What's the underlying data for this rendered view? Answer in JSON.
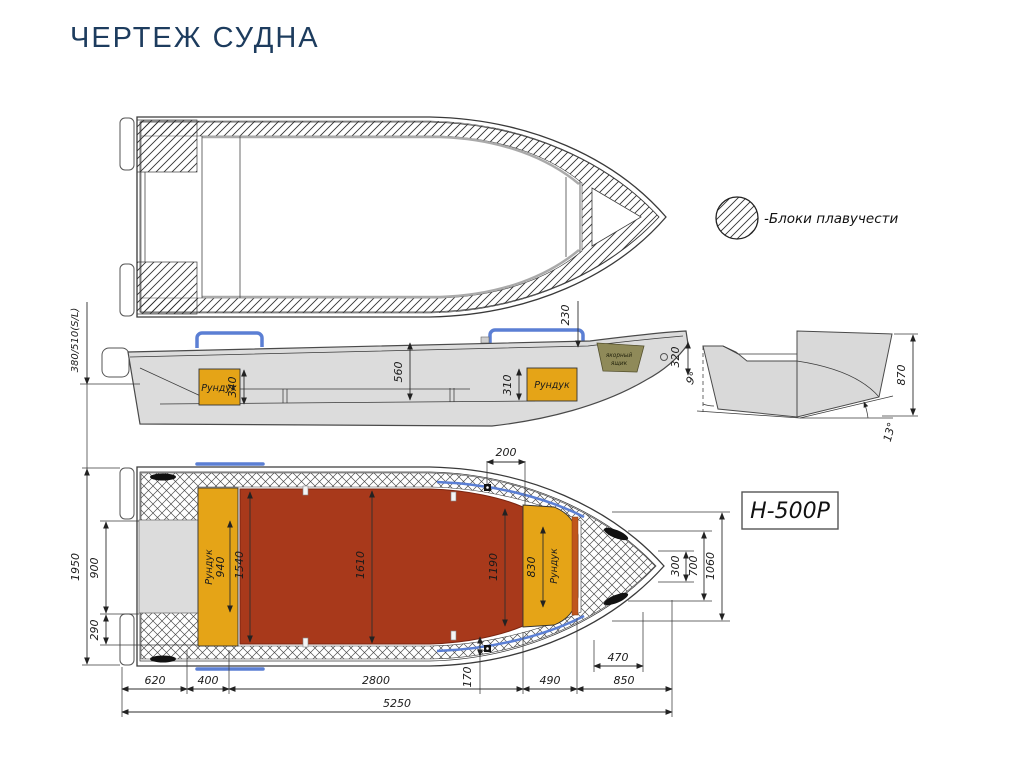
{
  "page": {
    "title": "ЧЕРТЕЖ СУДНА"
  },
  "legend": {
    "buoyancy_label": "-Блоки плавучести"
  },
  "model_plate": {
    "code": "Н-500Р"
  },
  "side_view": {
    "aft_locker_label": "Рундук",
    "bow_locker_label": "Рундук",
    "anchor_box_line1": "якорный",
    "anchor_box_line2": "ящик",
    "dims": {
      "transom_height": "380/510(S/L)",
      "d230": "230",
      "d320": "320",
      "d560": "560",
      "d340": "340",
      "d310": "310"
    }
  },
  "section_view": {
    "dims": {
      "d870": "870",
      "angle_side": "9°",
      "angle_bottom": "13°"
    }
  },
  "plan_view": {
    "aft_locker_label": "Рундук",
    "bow_locker_label": "Рундук",
    "dims": {
      "d200": "200",
      "d1950": "1950",
      "d900": "900",
      "d290": "290",
      "d940": "940",
      "d1540": "1540",
      "d1610": "1610",
      "d1190": "1190",
      "d830": "830",
      "d300": "300",
      "d700": "700",
      "d1060": "1060",
      "d470": "470",
      "d170": "170",
      "d620": "620",
      "d400": "400",
      "d2800": "2800",
      "d490": "490",
      "d850": "850",
      "d5250": "5250"
    }
  },
  "colors": {
    "title": "#1d3c5e",
    "hull": "#dcdcdc",
    "floor": "#a8391b",
    "locker": "#e5a417",
    "anchor_box": "#8f8a59",
    "rail": "#5b7fd4"
  }
}
